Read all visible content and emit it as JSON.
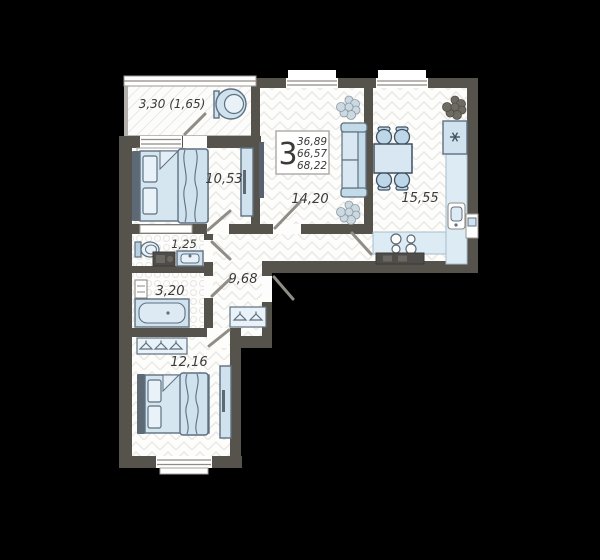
{
  "plan": {
    "type": "apartment-floor-plan",
    "summary": {
      "rooms_count": "3",
      "living_area": "36,89",
      "area_without_balcony": "66,57",
      "total_area": "68,22"
    },
    "rooms": [
      {
        "id": "balcony",
        "label": "3,30 (1,65)"
      },
      {
        "id": "bedroom-1",
        "label": "10,53"
      },
      {
        "id": "living-room",
        "label": "14,20"
      },
      {
        "id": "kitchen",
        "label": "15,55"
      },
      {
        "id": "wc",
        "label": "1,25"
      },
      {
        "id": "bathroom",
        "label": "3,20"
      },
      {
        "id": "hallway",
        "label": "9,68"
      },
      {
        "id": "bedroom-2",
        "label": "12,16"
      }
    ],
    "icons": {
      "fridge_mark": "*"
    },
    "colors": {
      "background": "#000000",
      "wall": "#56524c",
      "floor": "#fdfdfc",
      "furniture_blue": "#cfe2ee",
      "furniture_border": "#5f7080",
      "label_text": "#3b3a38"
    }
  }
}
